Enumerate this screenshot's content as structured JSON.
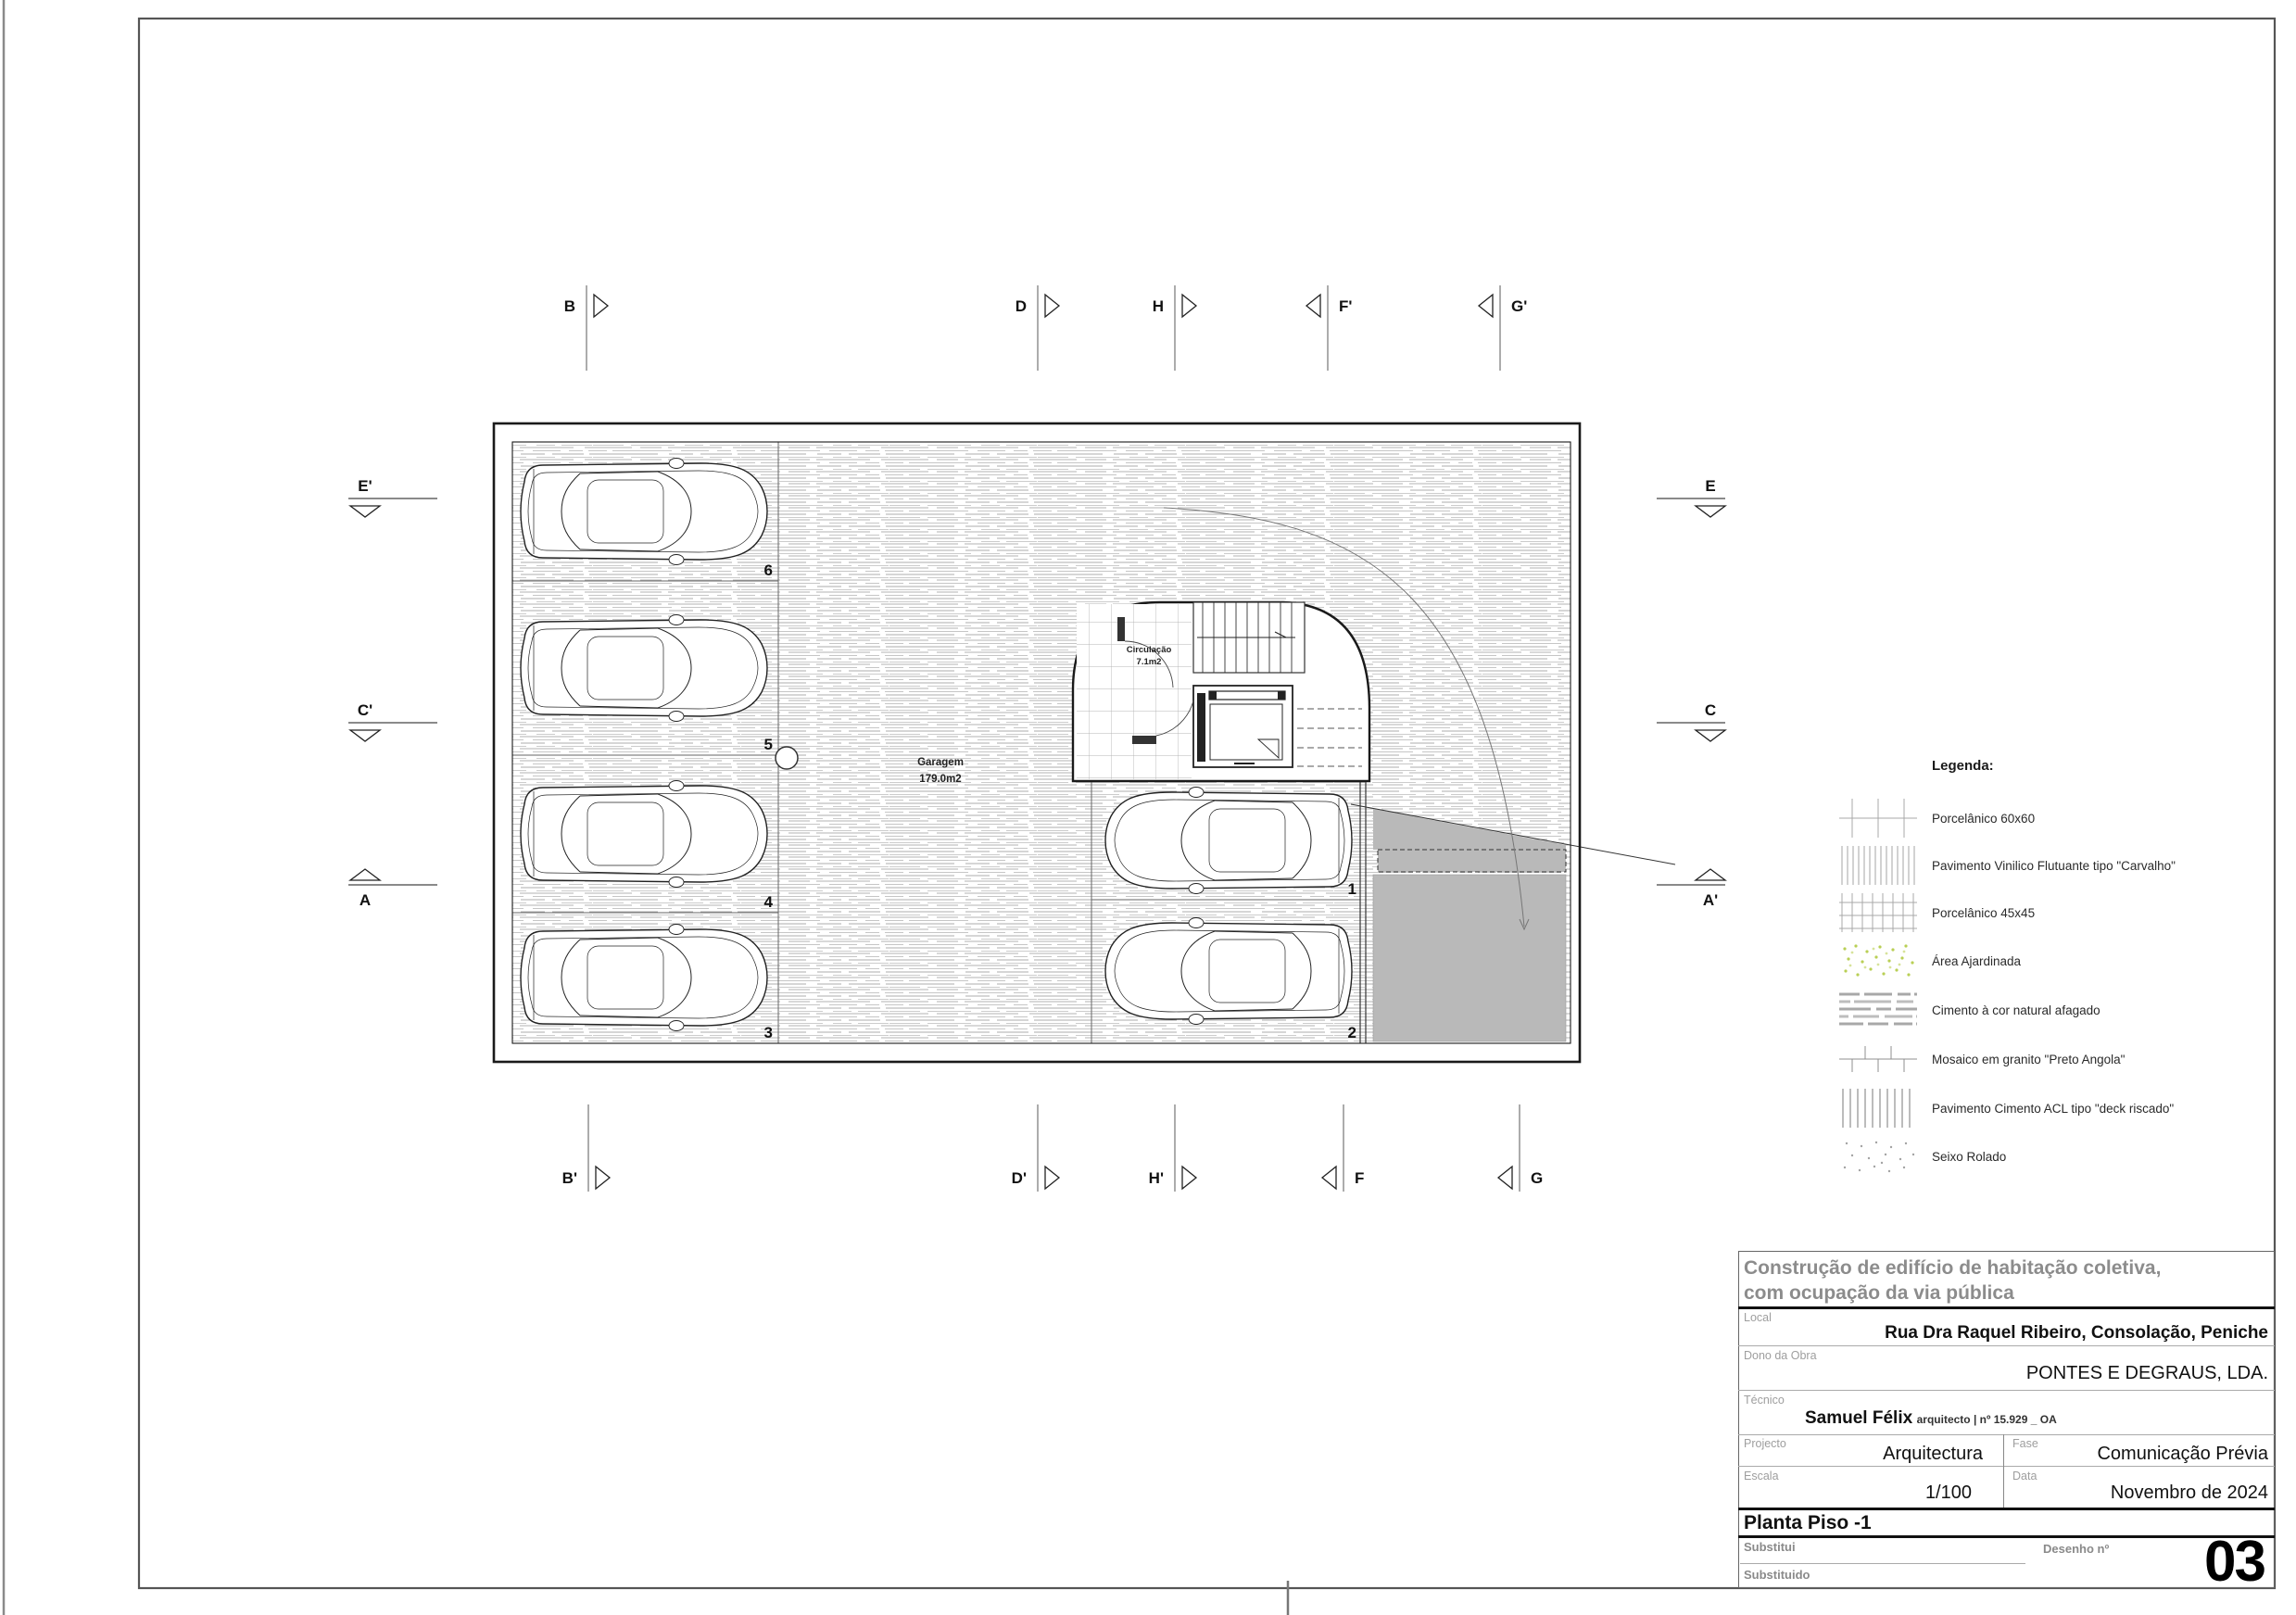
{
  "plan": {
    "garage": {
      "name": "Garagem",
      "area": "179.0m2"
    },
    "circulation": {
      "name": "Circulação",
      "area": "7.1m2"
    },
    "spots_left": [
      "6",
      "5",
      "4",
      "3"
    ],
    "spots_right": [
      "1",
      "2"
    ],
    "markers_top": [
      {
        "label": "B"
      },
      {
        "label": "D"
      },
      {
        "label": "H"
      },
      {
        "label": "F'"
      },
      {
        "label": "G'"
      }
    ],
    "markers_bottom": [
      {
        "label": "B'"
      },
      {
        "label": "D'"
      },
      {
        "label": "H'"
      },
      {
        "label": "F"
      },
      {
        "label": "G"
      }
    ],
    "markers_left": [
      {
        "label": "E'"
      },
      {
        "label": "C'"
      },
      {
        "label": "A"
      }
    ],
    "markers_right": [
      {
        "label": "E"
      },
      {
        "label": "C"
      },
      {
        "label": "A'"
      }
    ]
  },
  "legend": {
    "title": "Legenda:",
    "items": [
      {
        "label": "Porcelânico 60x60",
        "pattern": "porcelain-60"
      },
      {
        "label": "Pavimento Vinilico Flutuante tipo \"Carvalho\"",
        "pattern": "vinyl-plank"
      },
      {
        "label": "Porcelânico 45x45",
        "pattern": "porcelain-45"
      },
      {
        "label": "Área Ajardinada",
        "pattern": "garden"
      },
      {
        "label": "Cimento à cor natural afagado",
        "pattern": "cement"
      },
      {
        "label": "Mosaico em granito \"Preto Angola\"",
        "pattern": "granite-mosaic"
      },
      {
        "label": "Pavimento Cimento ACL tipo \"deck riscado\"",
        "pattern": "deck"
      },
      {
        "label": "Seixo Rolado",
        "pattern": "pebble"
      }
    ]
  },
  "title_block": {
    "project_title_line1": "Construção de edifício de habitação coletiva,",
    "project_title_line2": "com ocupação da via pública",
    "local_label": "Local",
    "local_value": "Rua Dra Raquel Ribeiro, Consolação, Peniche",
    "owner_label": "Dono da Obra",
    "owner_value": "PONTES E DEGRAUS, LDA.",
    "technician_label": "Técnico",
    "technician_name": "Samuel Félix",
    "technician_credentials": "arquitecto | nº 15.929 _ OA",
    "project_label": "Projecto",
    "project_value": "Arquitectura",
    "phase_label": "Fase",
    "phase_value": "Comunicação Prévia",
    "scale_label": "Escala",
    "scale_value": "1/100",
    "date_label": "Data",
    "date_value": "Novembro de 2024",
    "sheet_title": "Planta Piso -1",
    "replaces_label": "Substitui",
    "replaced_label": "Substituido",
    "drawing_no_label": "Desenho nº",
    "drawing_no_value": "03"
  },
  "colors": {
    "ramp_gray": "#b9b9b9",
    "hatch_gray": "#b3b3b3",
    "label_gray": "#9e9e9e",
    "header_gray": "#8c8c8c"
  }
}
